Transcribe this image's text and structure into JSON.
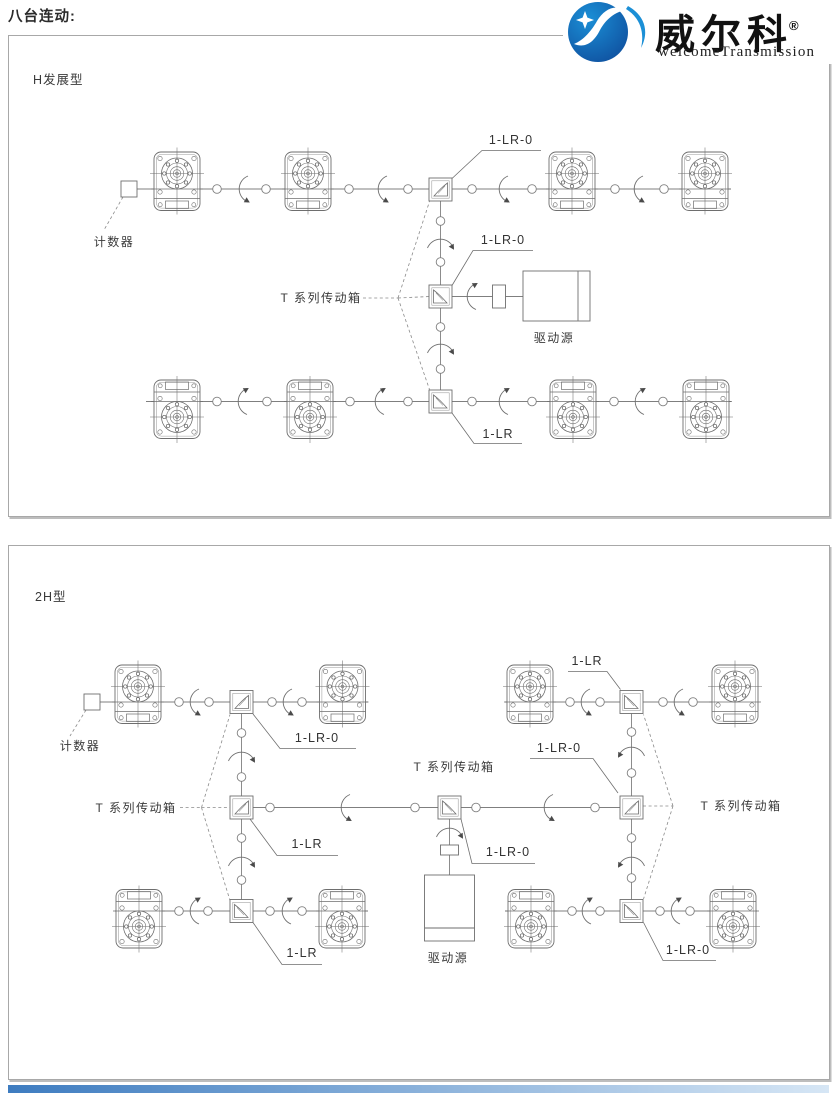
{
  "header": {
    "heading": "八台连动:",
    "logo": {
      "brand": "威尔科",
      "registered": "®",
      "subtitle": "welcomeTransmission"
    }
  },
  "colors": {
    "diagram_line": "#7f7f7f",
    "text": "#333333",
    "panel_border": "#a8a8a8",
    "logo_blue_dark": "#0f4f9e",
    "logo_blue_light": "#1b8fd6",
    "footer_bar_start": "#3e7cc0",
    "footer_bar_end": "#d6e6f5"
  },
  "panel1": {
    "title": "H发展型",
    "labels": {
      "counter": "计数器",
      "tseries": "T 系列传动箱",
      "drive": "驱动源",
      "lr0_top": "1-LR-0",
      "lr0_mid": "1-LR-0",
      "lr_bottom": "1-LR"
    }
  },
  "panel2": {
    "title": "2H型",
    "labels": {
      "counter": "计数器",
      "tseries_left": "T 系列传动箱",
      "tseries_center": "T 系列传动箱",
      "tseries_right": "T 系列传动箱",
      "drive": "驱动源",
      "lr0_a_left": "1-LR-0",
      "lr_b_left": "1-LR",
      "lr0_center": "1-LR-0",
      "lr_a_right": "1-LR",
      "lr0_r_mid": "1-LR-0",
      "lr_b2_left": "1-LR",
      "lr0_b2_right": "1-LR-0"
    }
  }
}
